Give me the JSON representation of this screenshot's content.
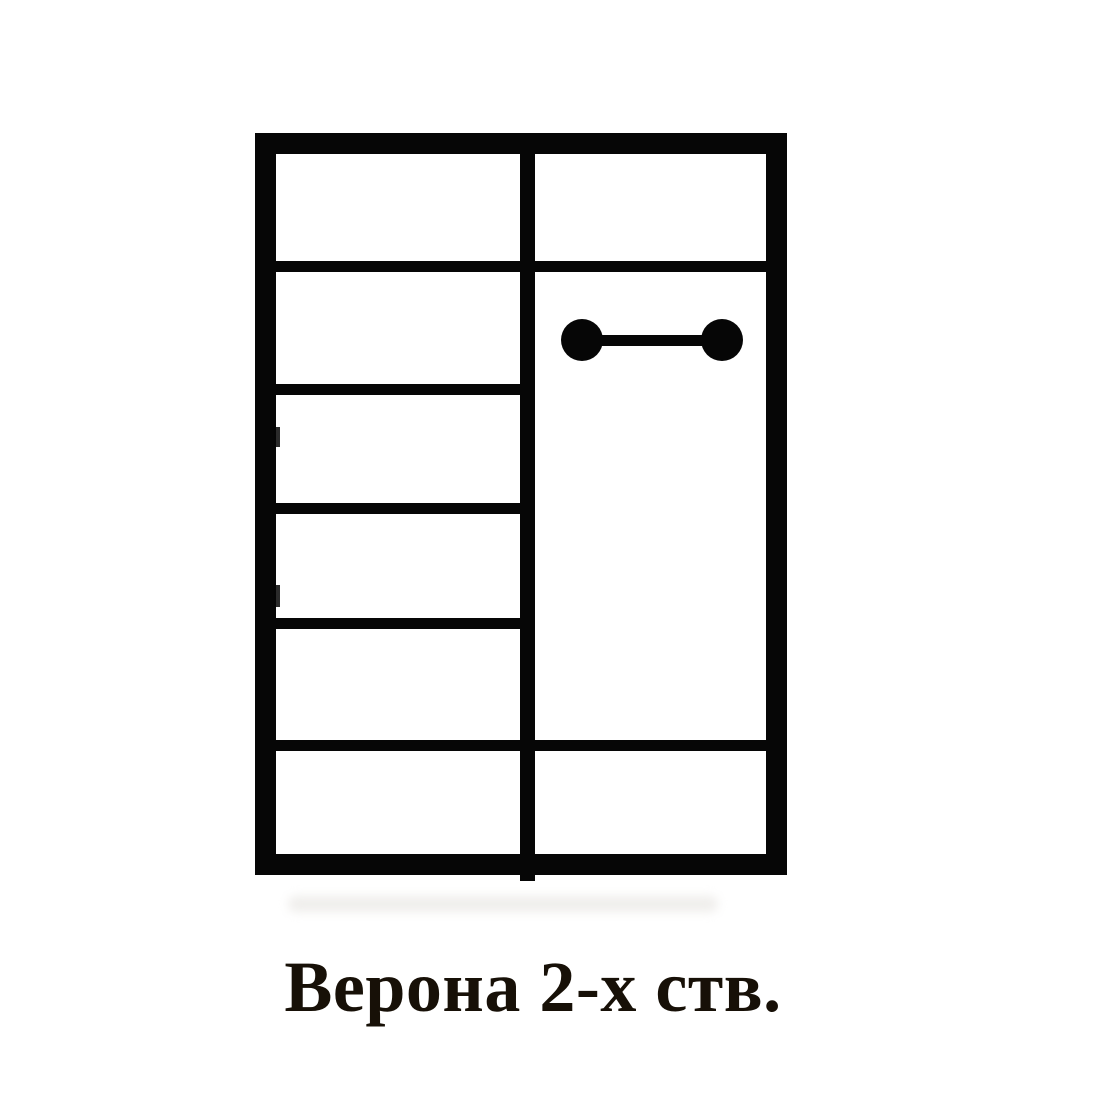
{
  "page": {
    "background_color": "#ffffff"
  },
  "caption": {
    "text": "Верона 2-х ств.",
    "color": "#171007",
    "font_size_px": 72
  },
  "diagram": {
    "kind": "wardrobe-front-scheme",
    "line_color": "#060606",
    "fill_color": "#ffffff",
    "outer_frame": {
      "x": 255,
      "y": 133,
      "width": 532,
      "height": 742,
      "border_px": 21
    },
    "center_divider": {
      "x": 520,
      "width": 15,
      "top": 140,
      "bottom": 881
    },
    "shelf_thickness_px": 11,
    "full_width_shelves_y": [
      261,
      740
    ],
    "shelf_full_x": 270,
    "shelf_full_width": 502,
    "left_column_shelves_y": [
      384,
      503,
      618
    ],
    "shelf_left_x": 270,
    "shelf_left_width": 262,
    "left_compartment_count": 6,
    "right_compartment_count": 3,
    "hanging_rail": {
      "bar_x": 582,
      "bar_width": 140,
      "bar_y": 335,
      "bar_height": 11,
      "end_diameter": 42,
      "end_centers_x": [
        582,
        722
      ],
      "center_y": 340
    },
    "hinge_marks": [
      {
        "y": 427,
        "height": 20
      },
      {
        "y": 585,
        "height": 22
      }
    ],
    "smudge": {
      "x": 288,
      "y": 896,
      "width": 430,
      "height": 16,
      "color": "#dcd9d4"
    }
  }
}
